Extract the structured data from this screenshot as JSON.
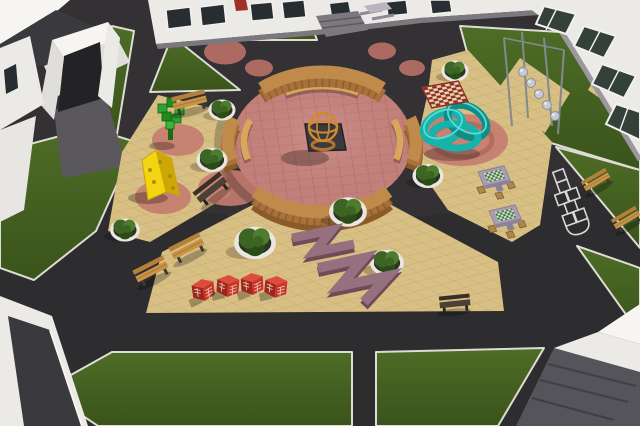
{
  "scene": {
    "name": "courtyard-playground-3d-render",
    "view": "aerial isometric render of a school courtyard play plaza"
  },
  "colors": {
    "asphalt": "#2d2c2e",
    "asphalt_light": "#4a4548",
    "lawn_light": "#4e6d26",
    "lawn_dark": "#3a531b",
    "curb": "#dedcd4",
    "tan": "#d8bf84",
    "pink_plaza": "#c8837d",
    "pink_circle": "#b76f66",
    "pink_circle_tan": "#c67d70",
    "swirl": "#aa5a52",
    "wood_face": "#8a5a28",
    "wood_mid": "#a9713a",
    "wood_top": "#c08b4a",
    "wood_bench": "#d8a75a",
    "bench_back": "#b5803a",
    "bench_seat": "#c99347",
    "bench_dark_back": "#382f27",
    "bench_dark_seat": "#4c3f33",
    "leg": "#3c3832",
    "planter_ring": "#e9e7e0",
    "soil": "#2c3524",
    "bush": "#3c6424",
    "bush_light": "#4d7c2c",
    "bush_dark": "#2b4c17",
    "red_cube": "#c7352a",
    "red_cube_dark": "#9e241c",
    "red_cube_top": "#df4c3e",
    "cube_lattice": "#f2ddc9",
    "yellow": "#f2d411",
    "yellow_dark": "#cda708",
    "teal": "#16b2ac",
    "teal_dark": "#0e8d89",
    "teal_light": "#56dcd6",
    "purple_top": "#95707e",
    "purple_side": "#6d4b58",
    "checker_red": "#8c2f2c",
    "checker_cream": "#e9d6a8",
    "chess_gray": "#a89db4",
    "chess_green": "#3c7a3c",
    "chess_white": "#d8ddd4",
    "stool": "#b08648",
    "metal": "#c4cad2",
    "metal_dark": "#84898f",
    "white_wall": "#ebeae7",
    "white_bright": "#f6f5f2",
    "wall_shade": "#dfdedb",
    "dark_roof": "#3a393d",
    "window": "#272d30",
    "window_green": "#33413a",
    "frame": "#f2f1ee",
    "base_gray": "#7b797e",
    "walkway": "#5a575d",
    "door_red": "#a03028",
    "pit": "#3a393e",
    "fire_orange": "#cf8a30",
    "fire_orange_dark": "#b5742a"
  },
  "inventory": {
    "amphitheater": {
      "label": "circular plaza with curved wooden plank walls",
      "wall_segments": 4,
      "inner_benches": 3
    },
    "fire_bowl": {
      "label": "orange sphere cage on dark plinth",
      "count": 1
    },
    "painted_circles_on_asphalt": 6,
    "painted_circles_on_paving": 4,
    "round_planters": 8,
    "wooden_benches": 5,
    "dark_benches": 2,
    "red_cube_seats": 4,
    "zigzag_benches": 2,
    "chess_tables": 2,
    "stools_per_table": 3,
    "ground_checkerboard": 1,
    "hopscotch_court": 1,
    "teal_knot_sculpture": 1,
    "yellow_climber_sculpture": 1,
    "pixel_tree_sculpture": 1,
    "sphere_pole_sculpture": {
      "poles": 4,
      "spheres": 5
    },
    "picnic_table": 1,
    "lawn_patches": 9,
    "buildings": 5
  }
}
